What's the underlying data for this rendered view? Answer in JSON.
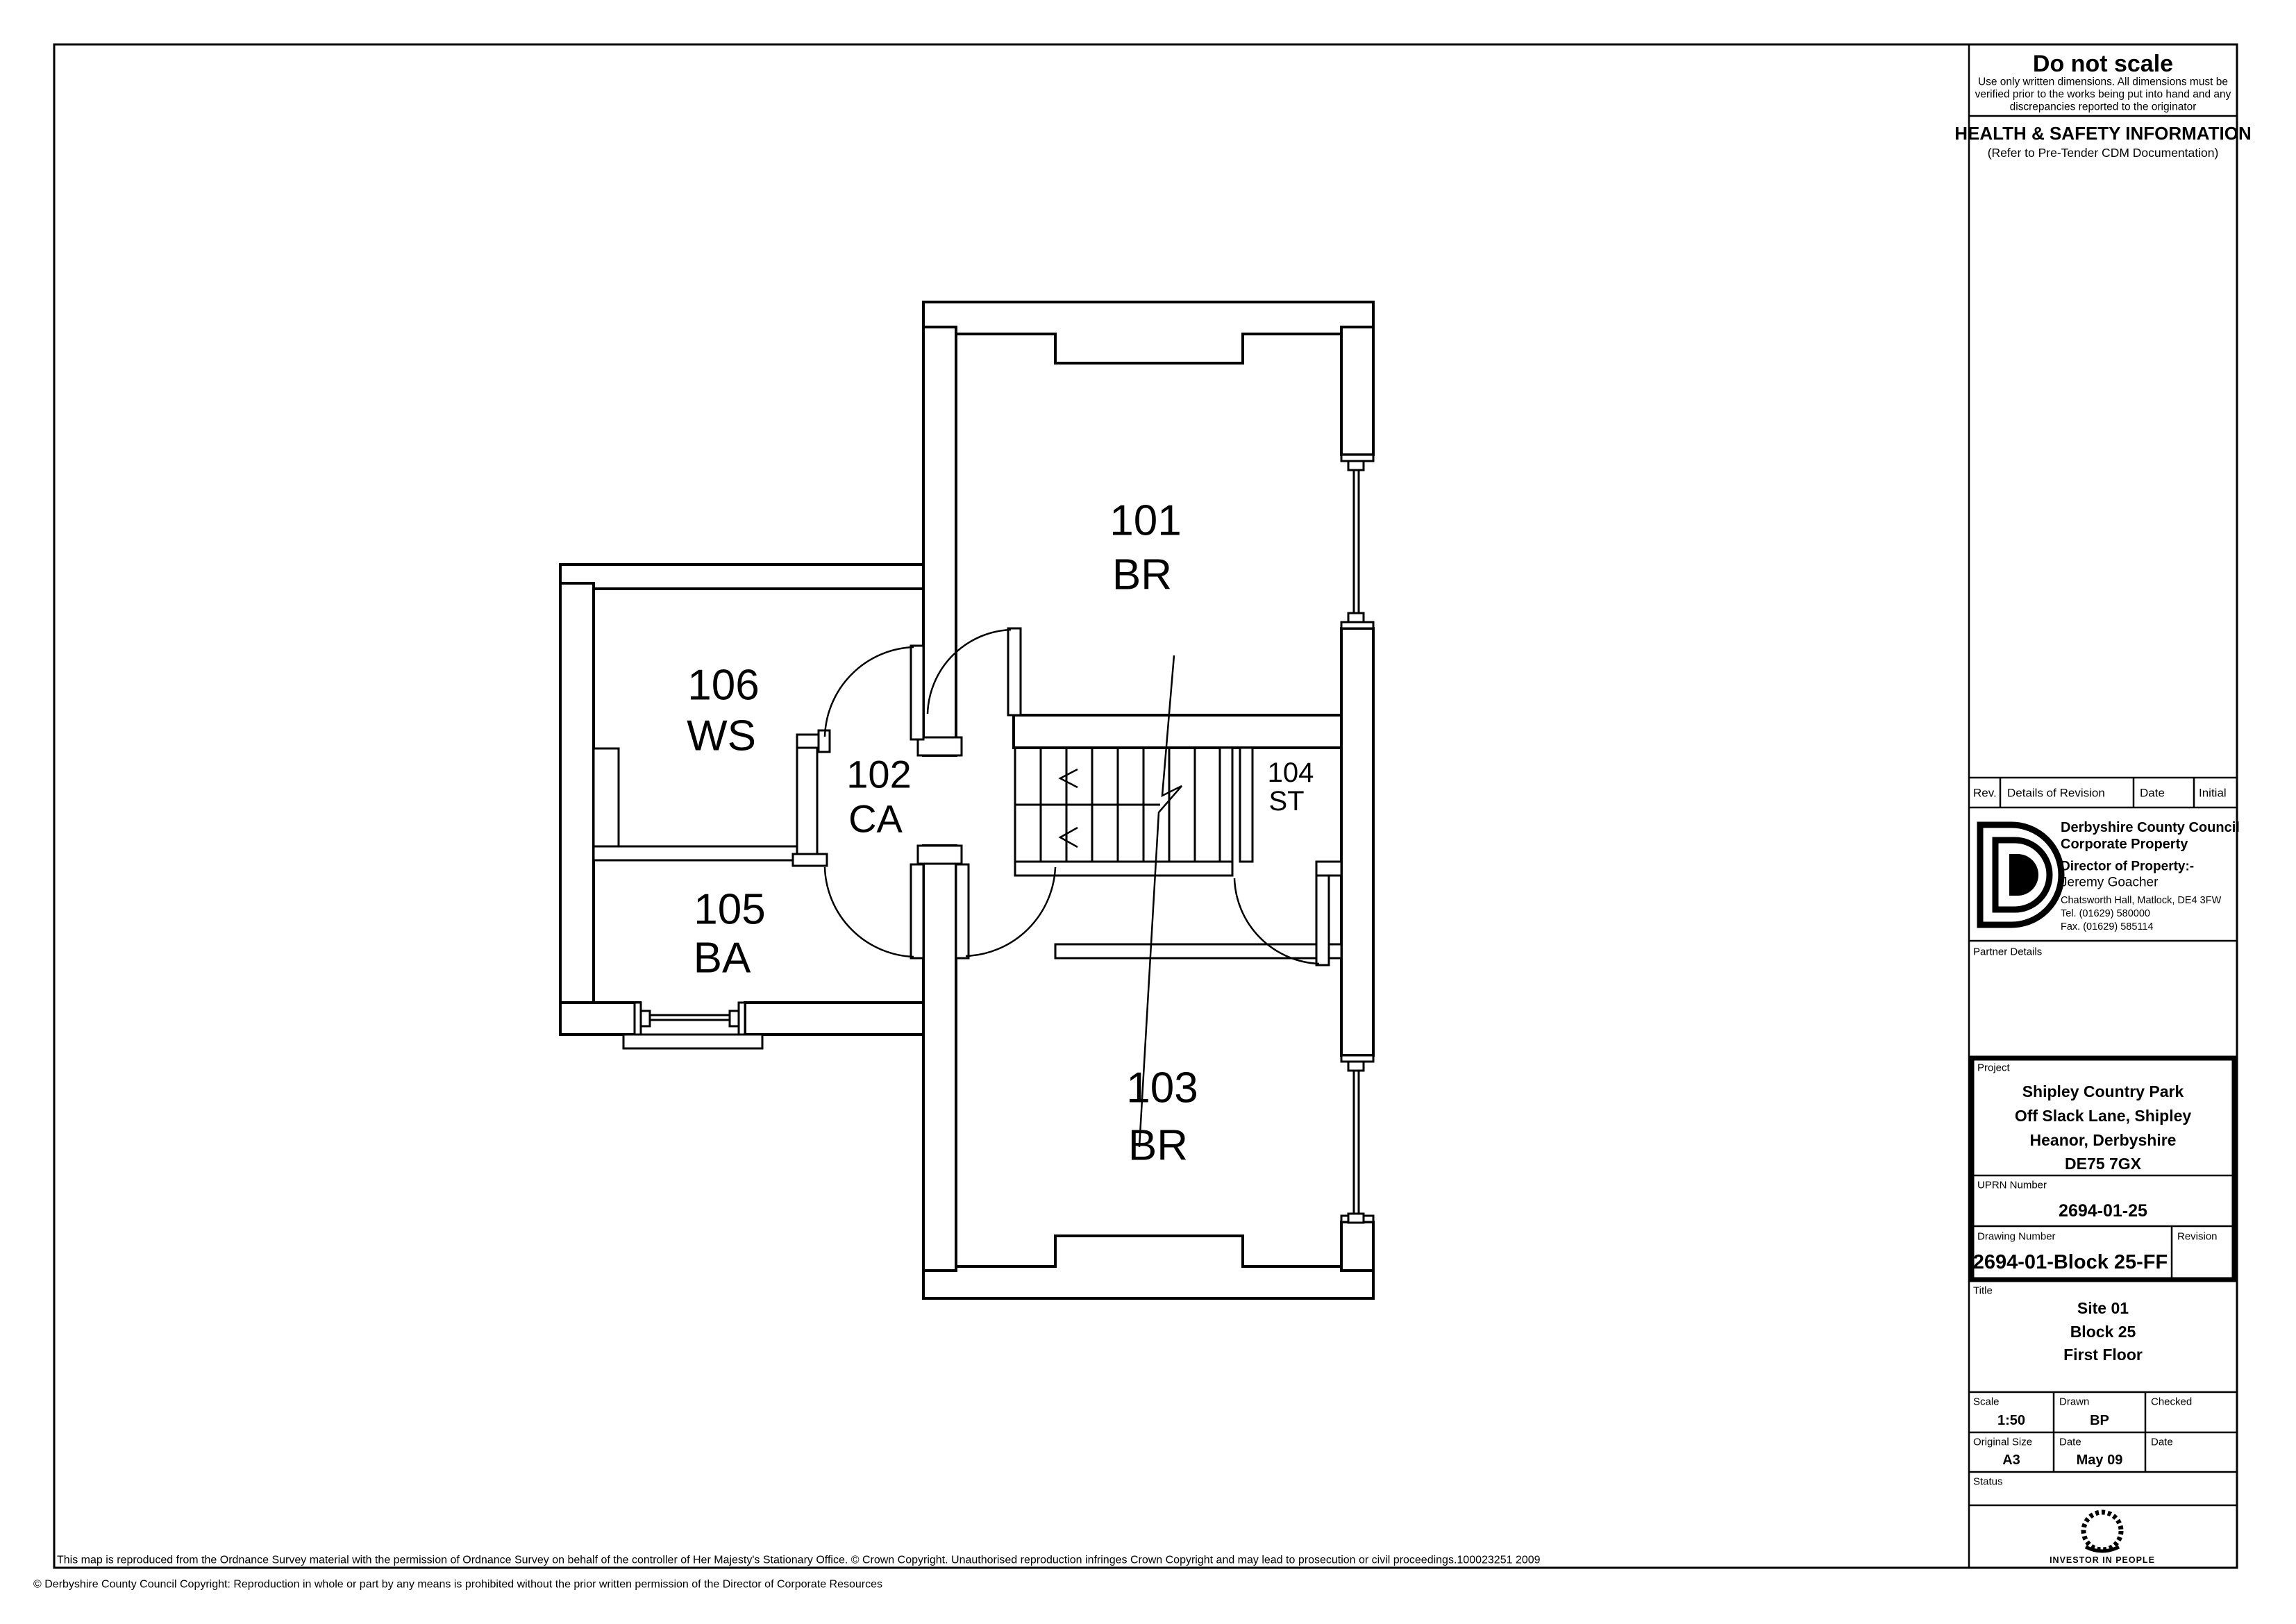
{
  "plan": {
    "rooms": [
      {
        "number": "101",
        "use": "BR"
      },
      {
        "number": "102",
        "use": "CA"
      },
      {
        "number": "103",
        "use": "BR"
      },
      {
        "number": "104",
        "use": "ST"
      },
      {
        "number": "105",
        "use": "BA"
      },
      {
        "number": "106",
        "use": "WS"
      }
    ]
  },
  "titleblock": {
    "do_not_scale": {
      "title": "Do not scale",
      "line1": "Use only written dimensions.  All dimensions must be",
      "line2": "verified prior to the works being put into hand and any",
      "line3": "discrepancies reported to the originator"
    },
    "health_safety": {
      "title": "HEALTH & SAFETY INFORMATION",
      "subtitle": "(Refer to Pre-Tender CDM Documentation)"
    },
    "revision_table": {
      "rev": "Rev.",
      "details": "Details of Revision",
      "date": "Date",
      "initial": "Initial"
    },
    "council": {
      "logo": "dcc-d-logo",
      "name": "Derbyshire County Council",
      "dept": "Corporate Property",
      "director_label": "Director of Property:-",
      "director": "Jeremy Goacher",
      "address": "Chatsworth Hall, Matlock, DE4 3FW",
      "tel": "Tel. (01629) 580000",
      "fax": "Fax. (01629) 585114"
    },
    "partner_details_label": "Partner Details",
    "project": {
      "label": "Project",
      "lines": [
        "Shipley Country Park",
        "Off Slack Lane, Shipley",
        "Heanor, Derbyshire",
        "DE75 7GX"
      ]
    },
    "uprn": {
      "label": "UPRN Number",
      "value": "2694-01-25"
    },
    "drawing_number": {
      "label": "Drawing Number",
      "value": "2694-01-Block 25-FF",
      "revision_label": "Revision"
    },
    "title": {
      "label": "Title",
      "lines": [
        "Site 01",
        "Block 25",
        "First Floor"
      ]
    },
    "scale": {
      "label": "Scale",
      "value": "1:50"
    },
    "drawn": {
      "label": "Drawn",
      "value": "BP"
    },
    "checked": {
      "label": "Checked",
      "value": ""
    },
    "original_size": {
      "label": "Original Size",
      "value": "A3"
    },
    "date": {
      "label": "Date",
      "value": "May 09"
    },
    "checked_date_label": "Date",
    "status_label": "Status",
    "iip": {
      "icon": "laurel-wreath-logo",
      "label": "INVESTOR IN PEOPLE"
    }
  },
  "footer": {
    "line1": "This map is reproduced from the Ordnance Survey material with the permission of Ordnance Survey on behalf of the controller of Her Majesty's Stationary Office. © Crown Copyright. Unauthorised reproduction infringes Crown Copyright and may lead to prosecution or civil proceedings.100023251 2009",
    "line2": "© Derbyshire County Council Copyright:  Reproduction in whole or part by any means is prohibited without the prior written permission of the Director of Corporate Resources"
  }
}
